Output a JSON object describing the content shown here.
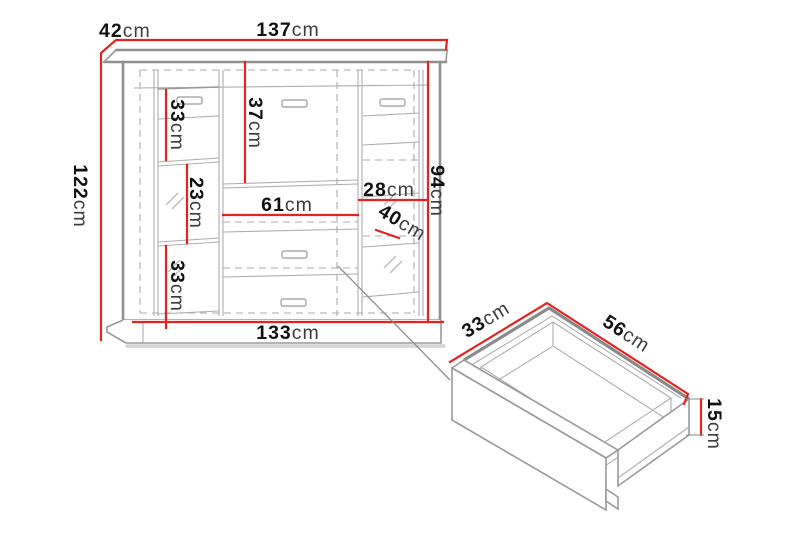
{
  "colors": {
    "dimension_red": "#e42320",
    "outline_gray": "#8f8f8f",
    "text_black": "#141414"
  },
  "cabinet": {
    "width_top": {
      "value": "137",
      "unit": "cm"
    },
    "depth_top": {
      "value": "42",
      "unit": "cm"
    },
    "height_left": {
      "value": "122",
      "unit": "cm"
    },
    "width_bottom": {
      "value": "133",
      "unit": "cm"
    },
    "height_right": {
      "value": "94",
      "unit": "cm"
    },
    "left_top_section": {
      "value": "33",
      "unit": "cm"
    },
    "left_middle_section": {
      "value": "23",
      "unit": "cm"
    },
    "left_bottom_section": {
      "value": "33",
      "unit": "cm"
    },
    "middle_top_section": {
      "value": "37",
      "unit": "cm"
    },
    "middle_inner_width": {
      "value": "61",
      "unit": "cm"
    },
    "right_inner_width": {
      "value": "28",
      "unit": "cm"
    },
    "right_shelf_spacing": {
      "value": "40",
      "unit": "cm"
    }
  },
  "drawer_detail": {
    "depth": {
      "value": "33",
      "unit": "cm"
    },
    "width": {
      "value": "56",
      "unit": "cm"
    },
    "height": {
      "value": "15",
      "unit": "cm"
    }
  }
}
